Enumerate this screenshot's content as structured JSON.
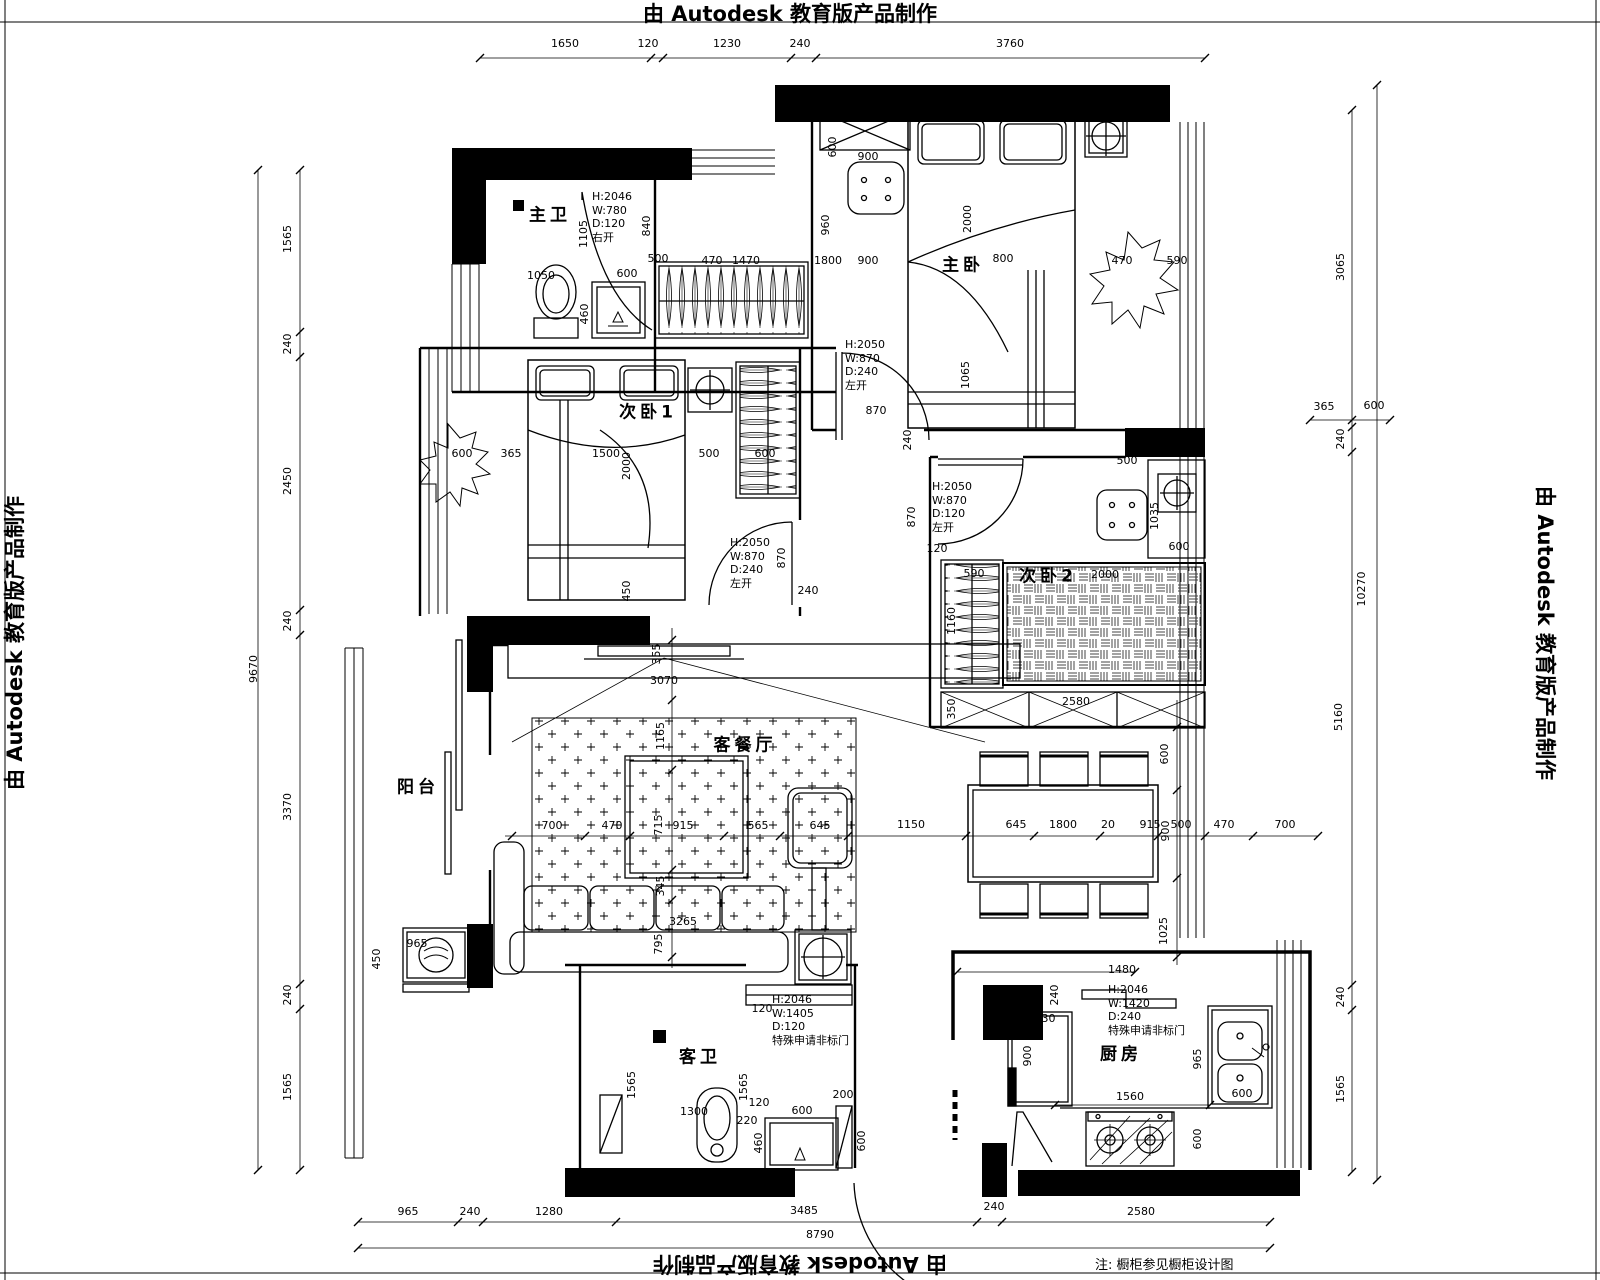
{
  "watermarks": {
    "top": "由 Autodesk 教育版产品制作",
    "bottom": "由 Autodesk 教育版产品制作",
    "left": "由 Autodesk 教育版产品制作",
    "right": "由 Autodesk 教育版产品制作"
  },
  "note": "注: 橱柜参见橱柜设计图",
  "rooms": [
    {
      "label": "主卫",
      "x": 550,
      "y": 213
    },
    {
      "label": "主卧",
      "x": 963,
      "y": 263
    },
    {
      "label": "次卧1",
      "x": 648,
      "y": 410
    },
    {
      "label": "次卧2",
      "x": 1048,
      "y": 574
    },
    {
      "label": "客餐厅",
      "x": 745,
      "y": 743
    },
    {
      "label": "阳台",
      "x": 418,
      "y": 785
    },
    {
      "label": "客卫",
      "x": 700,
      "y": 1055
    },
    {
      "label": "厨房",
      "x": 1121,
      "y": 1052
    }
  ],
  "door_specs": [
    {
      "x": 592,
      "y": 190,
      "lines": [
        "H:2046",
        "W:780",
        "D:120",
        "右开"
      ]
    },
    {
      "x": 845,
      "y": 338,
      "lines": [
        "H:2050",
        "W:870",
        "D:240",
        "左开"
      ]
    },
    {
      "x": 932,
      "y": 480,
      "lines": [
        "H:2050",
        "W:870",
        "D:120",
        "左开"
      ]
    },
    {
      "x": 730,
      "y": 536,
      "lines": [
        "H:2050",
        "W:870",
        "D:240",
        "左开"
      ]
    },
    {
      "x": 772,
      "y": 993,
      "lines": [
        "H:2046",
        "W:1405",
        "D:120",
        "特殊申请非标门"
      ]
    },
    {
      "x": 1108,
      "y": 983,
      "lines": [
        "H:2046",
        "W:1420",
        "D:240",
        "特殊申请非标门"
      ]
    }
  ],
  "dimensions": [
    {
      "t": "1650",
      "x": 565,
      "y": 45
    },
    {
      "t": "120",
      "x": 648,
      "y": 45
    },
    {
      "t": "1230",
      "x": 727,
      "y": 45
    },
    {
      "t": "240",
      "x": 800,
      "y": 45
    },
    {
      "t": "3760",
      "x": 1010,
      "y": 45
    },
    {
      "t": "1565",
      "x": 288,
      "y": 240,
      "v": 1
    },
    {
      "t": "240",
      "x": 288,
      "y": 345,
      "v": 1
    },
    {
      "t": "2450",
      "x": 288,
      "y": 482,
      "v": 1
    },
    {
      "t": "240",
      "x": 288,
      "y": 622,
      "v": 1
    },
    {
      "t": "3370",
      "x": 288,
      "y": 808,
      "v": 1
    },
    {
      "t": "240",
      "x": 288,
      "y": 996,
      "v": 1
    },
    {
      "t": "1565",
      "x": 288,
      "y": 1088,
      "v": 1
    },
    {
      "t": "9670",
      "x": 254,
      "y": 670,
      "v": 1
    },
    {
      "t": "3065",
      "x": 1341,
      "y": 268,
      "v": 1
    },
    {
      "t": "240",
      "x": 1341,
      "y": 440,
      "v": 1
    },
    {
      "t": "5160",
      "x": 1339,
      "y": 718,
      "v": 1
    },
    {
      "t": "240",
      "x": 1341,
      "y": 998,
      "v": 1
    },
    {
      "t": "1565",
      "x": 1341,
      "y": 1090,
      "v": 1
    },
    {
      "t": "10270",
      "x": 1362,
      "y": 590,
      "v": 1
    },
    {
      "t": "365",
      "x": 1324,
      "y": 408
    },
    {
      "t": "600",
      "x": 1374,
      "y": 407
    },
    {
      "t": "965",
      "x": 408,
      "y": 1213
    },
    {
      "t": "240",
      "x": 470,
      "y": 1213
    },
    {
      "t": "1280",
      "x": 549,
      "y": 1213
    },
    {
      "t": "3485",
      "x": 804,
      "y": 1212
    },
    {
      "t": "240",
      "x": 994,
      "y": 1208
    },
    {
      "t": "2580",
      "x": 1141,
      "y": 1213
    },
    {
      "t": "8790",
      "x": 820,
      "y": 1236
    },
    {
      "t": "1105",
      "x": 584,
      "y": 235,
      "v": 1
    },
    {
      "t": "840",
      "x": 647,
      "y": 227,
      "v": 1
    },
    {
      "t": "1050",
      "x": 541,
      "y": 277
    },
    {
      "t": "600",
      "x": 627,
      "y": 275
    },
    {
      "t": "460",
      "x": 585,
      "y": 315,
      "v": 1
    },
    {
      "t": "500",
      "x": 658,
      "y": 260
    },
    {
      "t": "470",
      "x": 712,
      "y": 262
    },
    {
      "t": "1470",
      "x": 746,
      "y": 262
    },
    {
      "t": "1800",
      "x": 828,
      "y": 262
    },
    {
      "t": "900",
      "x": 868,
      "y": 262
    },
    {
      "t": "800",
      "x": 1003,
      "y": 260
    },
    {
      "t": "470",
      "x": 1122,
      "y": 262
    },
    {
      "t": "590",
      "x": 1177,
      "y": 262
    },
    {
      "t": "960",
      "x": 826,
      "y": 226,
      "v": 1
    },
    {
      "t": "600",
      "x": 833,
      "y": 148,
      "v": 1
    },
    {
      "t": "900",
      "x": 868,
      "y": 158
    },
    {
      "t": "2000",
      "x": 968,
      "y": 220,
      "v": 1
    },
    {
      "t": "1065",
      "x": 966,
      "y": 376,
      "v": 1
    },
    {
      "t": "870",
      "x": 876,
      "y": 412
    },
    {
      "t": "240",
      "x": 908,
      "y": 441,
      "v": 1
    },
    {
      "t": "870",
      "x": 912,
      "y": 518,
      "v": 1
    },
    {
      "t": "120",
      "x": 937,
      "y": 550
    },
    {
      "t": "600",
      "x": 462,
      "y": 455
    },
    {
      "t": "365",
      "x": 511,
      "y": 455
    },
    {
      "t": "1500",
      "x": 606,
      "y": 455
    },
    {
      "t": "2000",
      "x": 627,
      "y": 467,
      "v": 1
    },
    {
      "t": "500",
      "x": 709,
      "y": 455
    },
    {
      "t": "600",
      "x": 765,
      "y": 455
    },
    {
      "t": "450",
      "x": 627,
      "y": 592,
      "v": 1
    },
    {
      "t": "870",
      "x": 782,
      "y": 559,
      "v": 1
    },
    {
      "t": "240",
      "x": 808,
      "y": 592
    },
    {
      "t": "500",
      "x": 1127,
      "y": 462
    },
    {
      "t": "1035",
      "x": 1155,
      "y": 517,
      "v": 1
    },
    {
      "t": "600",
      "x": 1179,
      "y": 548
    },
    {
      "t": "2000",
      "x": 1105,
      "y": 576
    },
    {
      "t": "590",
      "x": 974,
      "y": 575
    },
    {
      "t": "1160",
      "x": 952,
      "y": 622,
      "v": 1
    },
    {
      "t": "350",
      "x": 952,
      "y": 710,
      "v": 1
    },
    {
      "t": "2580",
      "x": 1076,
      "y": 703
    },
    {
      "t": "3070",
      "x": 664,
      "y": 682
    },
    {
      "t": "355",
      "x": 657,
      "y": 655,
      "v": 1
    },
    {
      "t": "1165",
      "x": 661,
      "y": 737,
      "v": 1
    },
    {
      "t": "715",
      "x": 659,
      "y": 826,
      "v": 1
    },
    {
      "t": "345",
      "x": 661,
      "y": 887,
      "v": 1
    },
    {
      "t": "795",
      "x": 659,
      "y": 945,
      "v": 1
    },
    {
      "t": "3265",
      "x": 683,
      "y": 923
    },
    {
      "t": "450",
      "x": 377,
      "y": 960,
      "v": 1
    },
    {
      "t": "965",
      "x": 417,
      "y": 945
    },
    {
      "t": "700",
      "x": 552,
      "y": 827
    },
    {
      "t": "470",
      "x": 612,
      "y": 827
    },
    {
      "t": "915",
      "x": 683,
      "y": 827
    },
    {
      "t": "565",
      "x": 758,
      "y": 827
    },
    {
      "t": "645",
      "x": 820,
      "y": 827
    },
    {
      "t": "1150",
      "x": 911,
      "y": 826
    },
    {
      "t": "645",
      "x": 1016,
      "y": 826
    },
    {
      "t": "1800",
      "x": 1063,
      "y": 826
    },
    {
      "t": "20",
      "x": 1108,
      "y": 826
    },
    {
      "t": "915",
      "x": 1150,
      "y": 826
    },
    {
      "t": "500",
      "x": 1181,
      "y": 826
    },
    {
      "t": "470",
      "x": 1224,
      "y": 826
    },
    {
      "t": "700",
      "x": 1285,
      "y": 826
    },
    {
      "t": "600",
      "x": 1165,
      "y": 755,
      "v": 1
    },
    {
      "t": "900",
      "x": 1166,
      "y": 832,
      "v": 1
    },
    {
      "t": "1025",
      "x": 1164,
      "y": 932,
      "v": 1
    },
    {
      "t": "1480",
      "x": 1122,
      "y": 971
    },
    {
      "t": "240",
      "x": 1055,
      "y": 996,
      "v": 1
    },
    {
      "t": "630",
      "x": 1045,
      "y": 1020
    },
    {
      "t": "900",
      "x": 1028,
      "y": 1057,
      "v": 1
    },
    {
      "t": "1560",
      "x": 1130,
      "y": 1098
    },
    {
      "t": "965",
      "x": 1198,
      "y": 1060,
      "v": 1
    },
    {
      "t": "600",
      "x": 1242,
      "y": 1095
    },
    {
      "t": "600",
      "x": 1198,
      "y": 1140,
      "v": 1
    },
    {
      "t": "1565",
      "x": 632,
      "y": 1086,
      "v": 1
    },
    {
      "t": "1565",
      "x": 744,
      "y": 1088,
      "v": 1
    },
    {
      "t": "1300",
      "x": 694,
      "y": 1113
    },
    {
      "t": "220",
      "x": 747,
      "y": 1122
    },
    {
      "t": "120",
      "x": 759,
      "y": 1104
    },
    {
      "t": "460",
      "x": 759,
      "y": 1144,
      "v": 1
    },
    {
      "t": "600",
      "x": 802,
      "y": 1112
    },
    {
      "t": "200",
      "x": 843,
      "y": 1096
    },
    {
      "t": "600",
      "x": 862,
      "y": 1142,
      "v": 1
    },
    {
      "t": "120",
      "x": 762,
      "y": 1010
    }
  ]
}
